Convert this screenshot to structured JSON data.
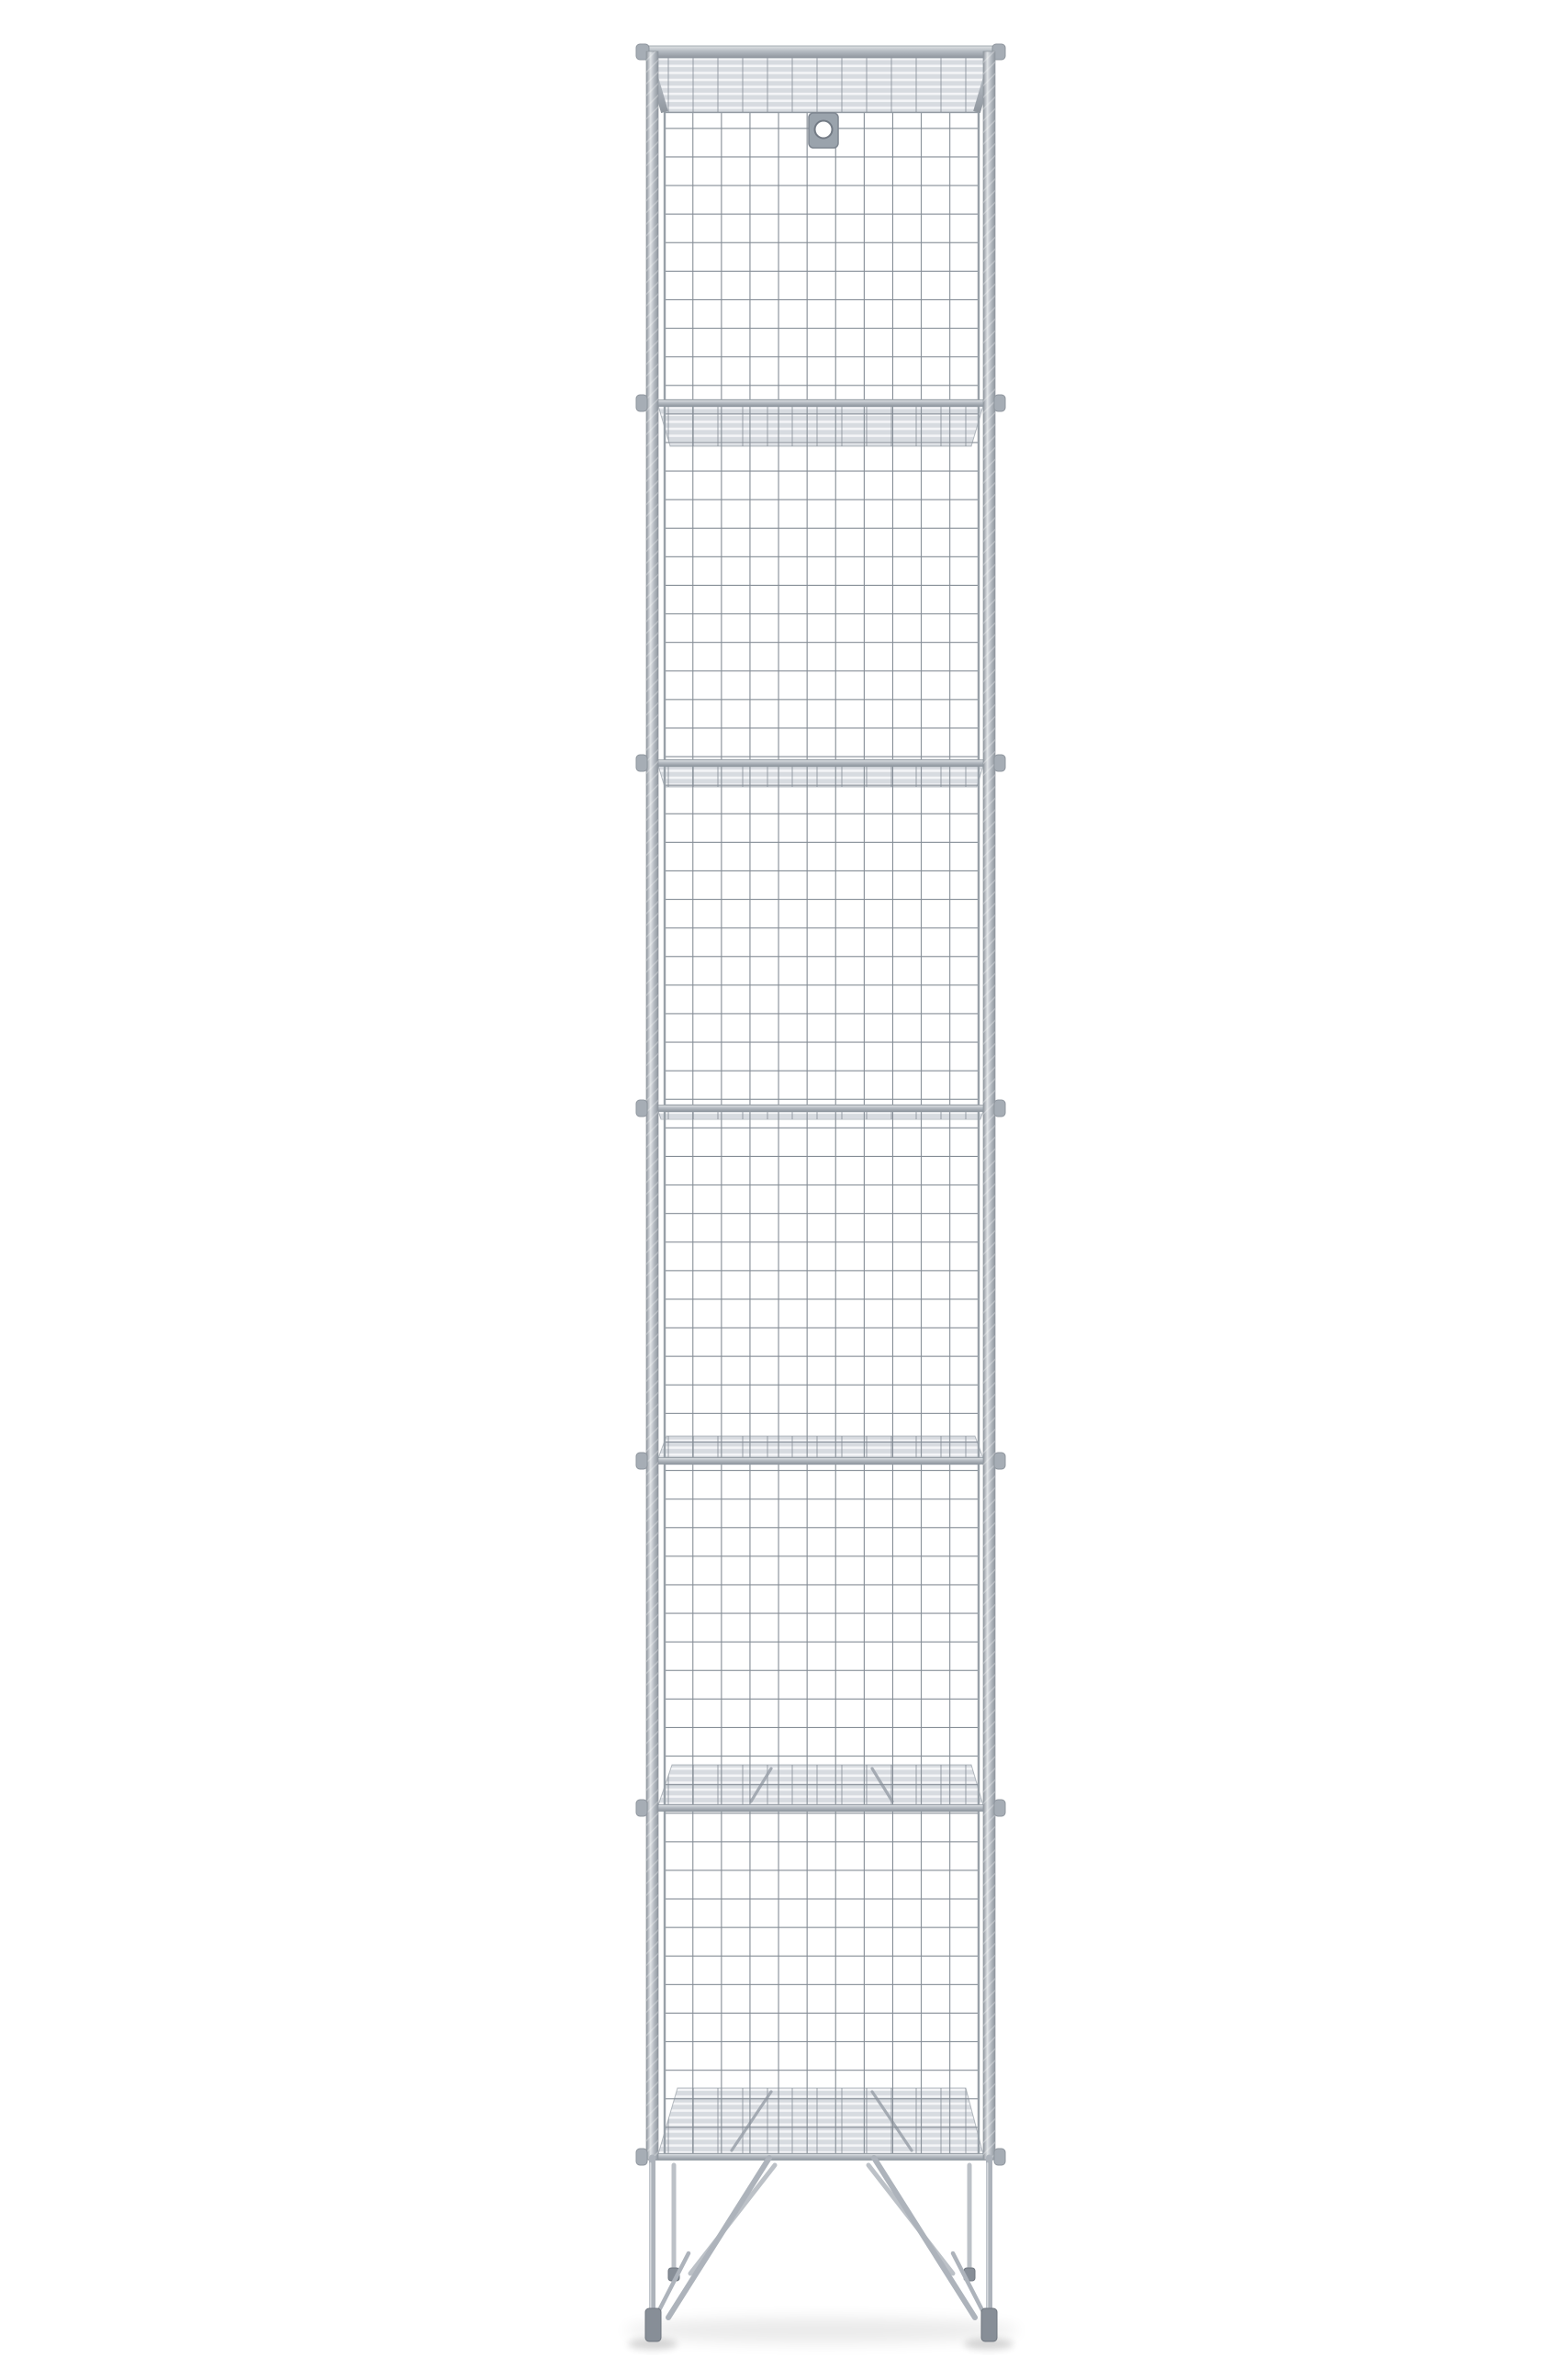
{
  "figure": {
    "alt": "Tall narrow galvanised wire mesh locker with six open compartments, a sloped mesh top, a wall-fixing tab with a screw hole, wire grid front panels, mesh shelves and splayed wire legs, photographed on a plain white background",
    "compartment_count": "6",
    "shelf_count": "5"
  },
  "parts": {
    "sloped_top": "sloped mesh top",
    "mount_tab": "wall-fixing tab with screw hole",
    "front_panel": "wire grid front panel",
    "shelf": "wire mesh shelf",
    "side_rail": "twisted wire side rail",
    "legs": "splayed wire legs",
    "feet": "floor feet"
  },
  "colors": {
    "background": "#ffffff",
    "frame_light": "#e0e3e6",
    "frame_mid": "#b4bac1",
    "frame_dark": "#8f969e",
    "mesh_wire": "#848c95",
    "panel_wire": "#98a0a8",
    "band_base": "#d7dbe0",
    "band_stripe": "#f4f5f7",
    "nub": "#a6adb5",
    "tab_plate": "#9aa3ac",
    "leg": "#adb3bb",
    "leg_back": "#bcc1c7",
    "foot": "#878e97"
  }
}
